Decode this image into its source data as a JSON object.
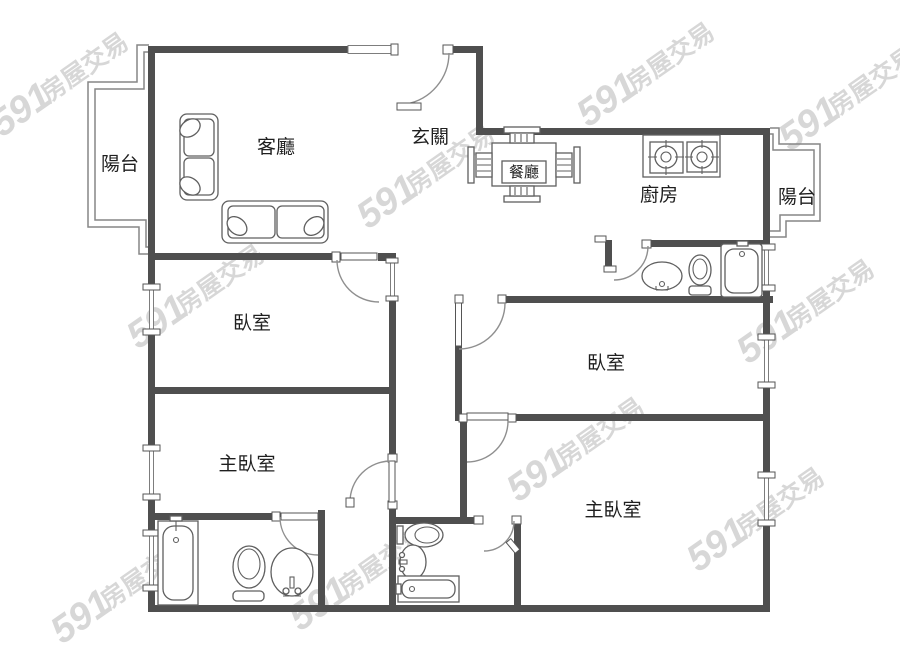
{
  "page": {
    "type": "floor-plan",
    "background": "#ffffff"
  },
  "watermark": {
    "brand": "591",
    "suffix": "房屋交易",
    "color": "#d7d7d7"
  },
  "colors": {
    "wall": "#4f4f4f",
    "thin_line": "#868686",
    "fixture": "#5f5f5f",
    "label": "#1f1f1f"
  },
  "rooms": {
    "balcony_left": {
      "label": "陽台"
    },
    "living_room": {
      "label": "客廳"
    },
    "entrance": {
      "label": "玄關"
    },
    "dining": {
      "label": "餐廳"
    },
    "kitchen": {
      "label": "廚房"
    },
    "balcony_right": {
      "label": "陽台"
    },
    "bedroom_left": {
      "label": "臥室"
    },
    "bedroom_right": {
      "label": "臥室"
    },
    "master_left": {
      "label": "主臥室"
    },
    "master_right": {
      "label": "主臥室"
    }
  }
}
